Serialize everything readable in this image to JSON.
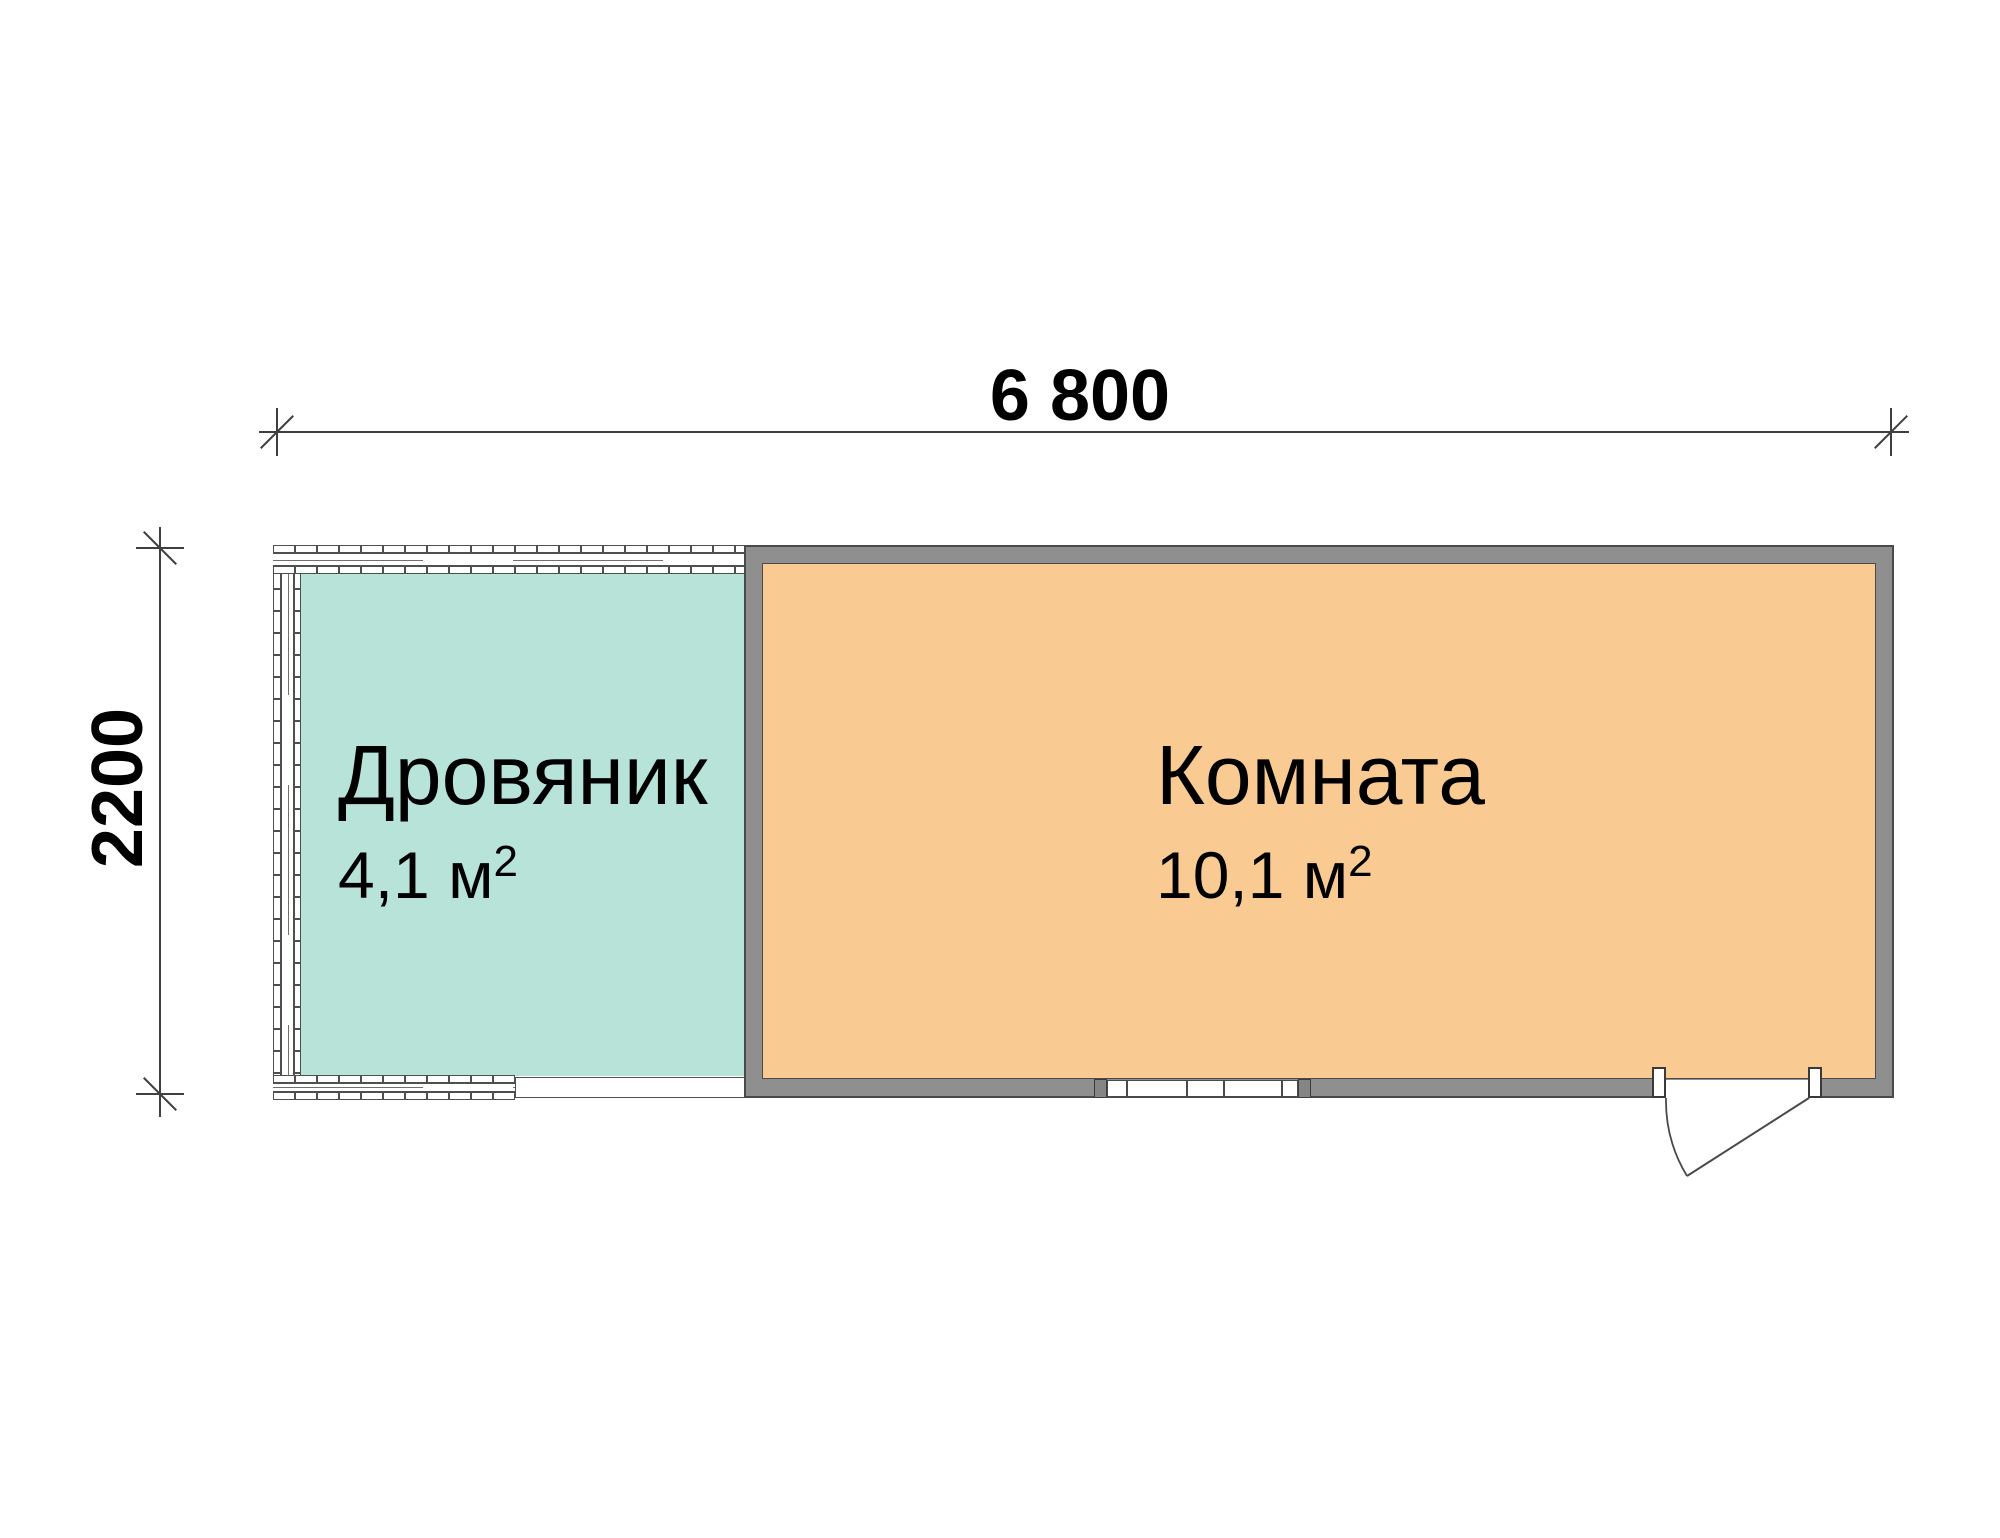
{
  "floor_plan": {
    "dimensions": {
      "width_mm": "6 800",
      "height_mm": "2200"
    },
    "rooms": [
      {
        "name": "Дровяник",
        "area": "4,1 м",
        "area_sup": "2",
        "fill": "#b7e3d9"
      },
      {
        "name": "Комната",
        "area": "10,1 м",
        "area_sup": "2",
        "fill": "#f9cb93"
      }
    ],
    "colors": {
      "wall_gray": "#8f8f8f",
      "outline": "#4a4a4a",
      "dimension_line": "#3f3f3f",
      "background": "#ffffff"
    }
  }
}
